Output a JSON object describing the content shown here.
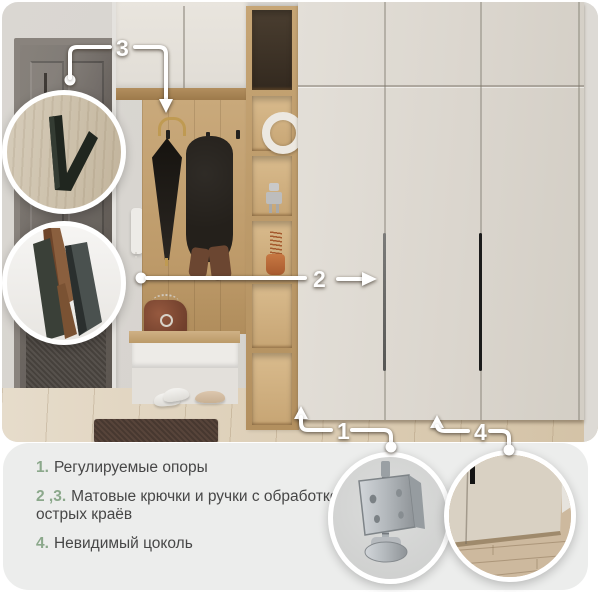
{
  "callouts": {
    "c1": "1",
    "c2": "2",
    "c3": "3",
    "c4": "4"
  },
  "features": [
    {
      "num": "1.",
      "text": "Регулируемые опоры"
    },
    {
      "num": "2 ,3.",
      "text": "Матовые крючки и ручки с обработкой острых краёв"
    },
    {
      "num": "4.",
      "text": "Невидимый цоколь"
    }
  ],
  "colors": {
    "accent_green": "#8ba88b",
    "body_text": "#474747",
    "panel_bg": "#ecedec",
    "callout": "#ffffff"
  }
}
